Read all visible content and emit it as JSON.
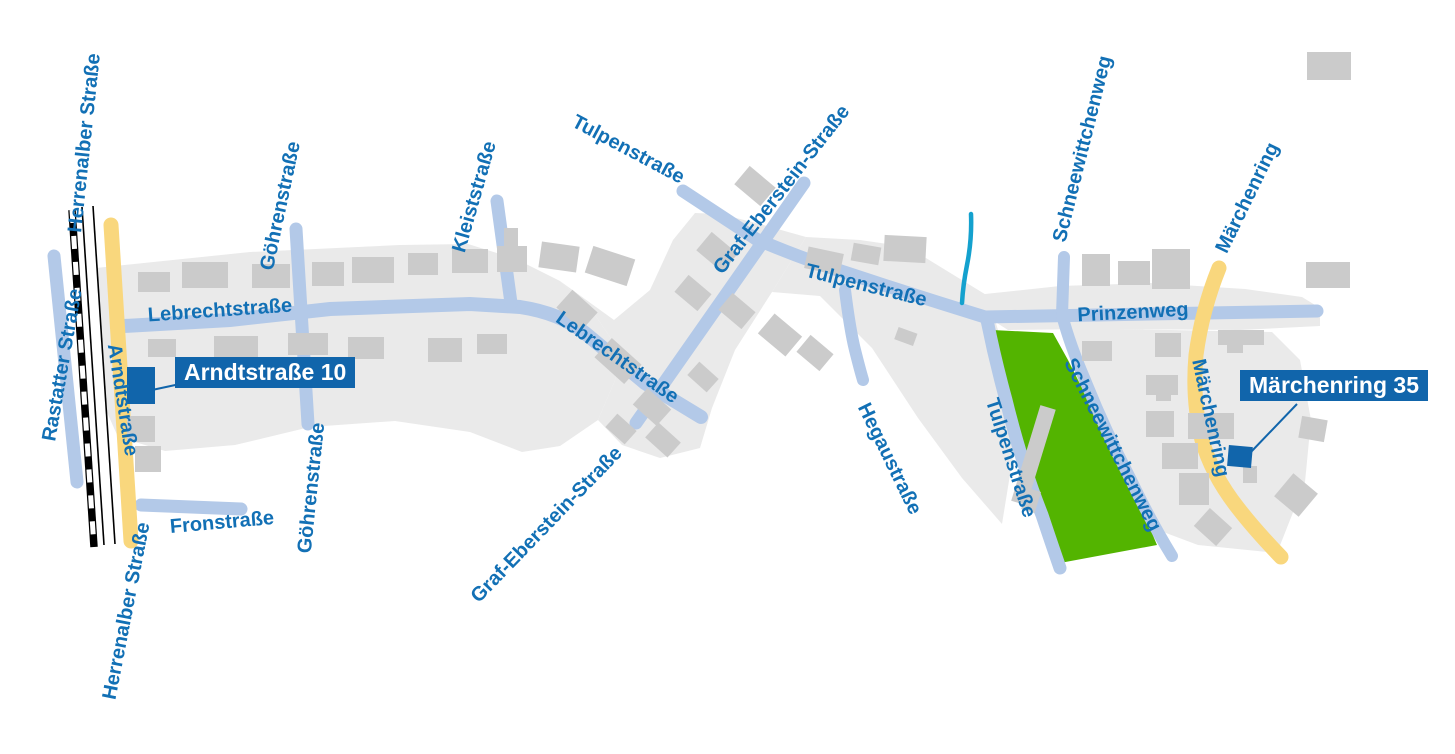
{
  "title": "Stadtplan-Ausschnitt",
  "streets": {
    "herrenalber": "Herrenalber Straße",
    "rastatter": "Rastatter Straße",
    "arndtstrasse": "Arndtstraße",
    "fronstrasse": "Fronstraße",
    "lebrechtstrasse": "Lebrechtstraße",
    "goehrenstrasse": "Göhrenstraße",
    "kleiststrasse": "Kleiststraße",
    "tulpenstrasse": "Tulpenstraße",
    "graf_eberstein": "Graf-Eberstein-Straße",
    "hegaustrasse": "Hegaustraße",
    "prinzenweg": "Prinzenweg",
    "schneewittchenweg": "Schneewittchenweg",
    "maerchenring": "Märchenring"
  },
  "addresses": {
    "arndtstrasse_10": "Arndtstraße 10",
    "maerchenring_35": "Märchenring 35"
  },
  "colors": {
    "street": "#b3c9e8",
    "main_road_yellow": "#f9d77d",
    "park_green": "#53b400",
    "building_gray": "#cbcbcb",
    "area_gray": "#eaeaea",
    "label_text_blue": "#1270b5",
    "address_box_blue": "#1165ab",
    "stream_cyan": "#14a1ce",
    "railway_black": "#000000"
  }
}
